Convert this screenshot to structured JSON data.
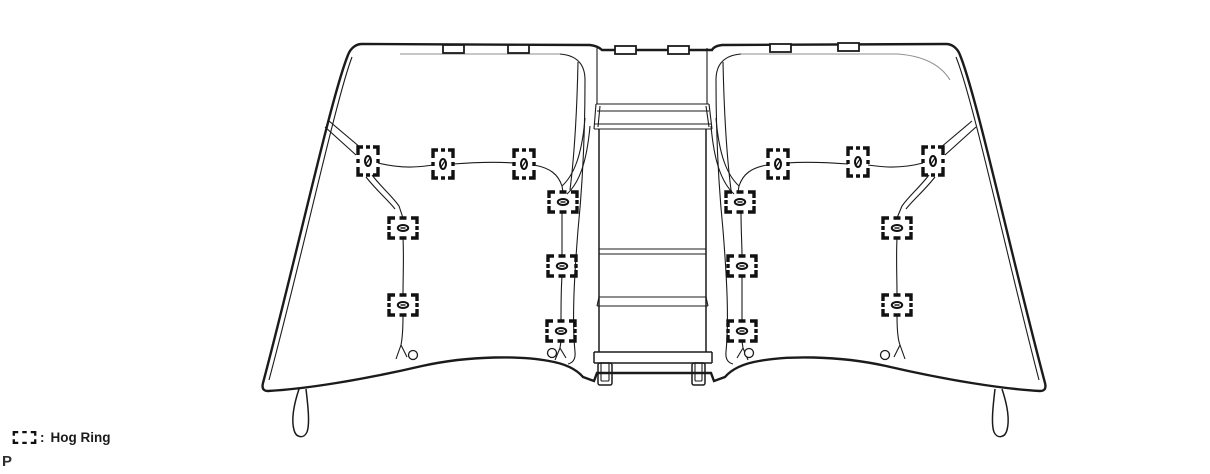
{
  "legend": {
    "symbol_name": "hog-ring-symbol",
    "separator": ":",
    "label": "Hog Ring",
    "page_marker": "P"
  },
  "colors": {
    "background": "#ffffff",
    "line": "#1b1b1b",
    "faint_line": "#8f8f8f"
  },
  "diagram": {
    "hog_rings": [
      {
        "x": 368,
        "y": 161,
        "orientation": "v"
      },
      {
        "x": 443,
        "y": 164,
        "orientation": "v"
      },
      {
        "x": 524,
        "y": 164,
        "orientation": "v"
      },
      {
        "x": 778,
        "y": 164,
        "orientation": "v"
      },
      {
        "x": 858,
        "y": 162,
        "orientation": "v"
      },
      {
        "x": 933,
        "y": 161,
        "orientation": "v"
      },
      {
        "x": 403,
        "y": 228,
        "orientation": "h"
      },
      {
        "x": 403,
        "y": 305,
        "orientation": "h"
      },
      {
        "x": 563,
        "y": 202,
        "orientation": "h"
      },
      {
        "x": 562,
        "y": 266,
        "orientation": "h"
      },
      {
        "x": 561,
        "y": 331,
        "orientation": "h"
      },
      {
        "x": 740,
        "y": 202,
        "orientation": "h"
      },
      {
        "x": 742,
        "y": 266,
        "orientation": "h"
      },
      {
        "x": 742,
        "y": 331,
        "orientation": "h"
      },
      {
        "x": 897,
        "y": 228,
        "orientation": "h"
      },
      {
        "x": 897,
        "y": 305,
        "orientation": "h"
      }
    ],
    "grommets": [
      {
        "x": 413,
        "y": 355
      },
      {
        "x": 552,
        "y": 353
      },
      {
        "x": 749,
        "y": 353
      },
      {
        "x": 885,
        "y": 355
      }
    ],
    "headrest_slots": [
      {
        "x": 443,
        "y": 45,
        "w": 21,
        "h": 8
      },
      {
        "x": 508,
        "y": 45,
        "w": 21,
        "h": 8
      },
      {
        "x": 615,
        "y": 46,
        "w": 21,
        "h": 8
      },
      {
        "x": 668,
        "y": 46,
        "w": 21,
        "h": 8
      },
      {
        "x": 770,
        "y": 44,
        "w": 21,
        "h": 8
      },
      {
        "x": 838,
        "y": 43,
        "w": 21,
        "h": 8
      }
    ]
  }
}
